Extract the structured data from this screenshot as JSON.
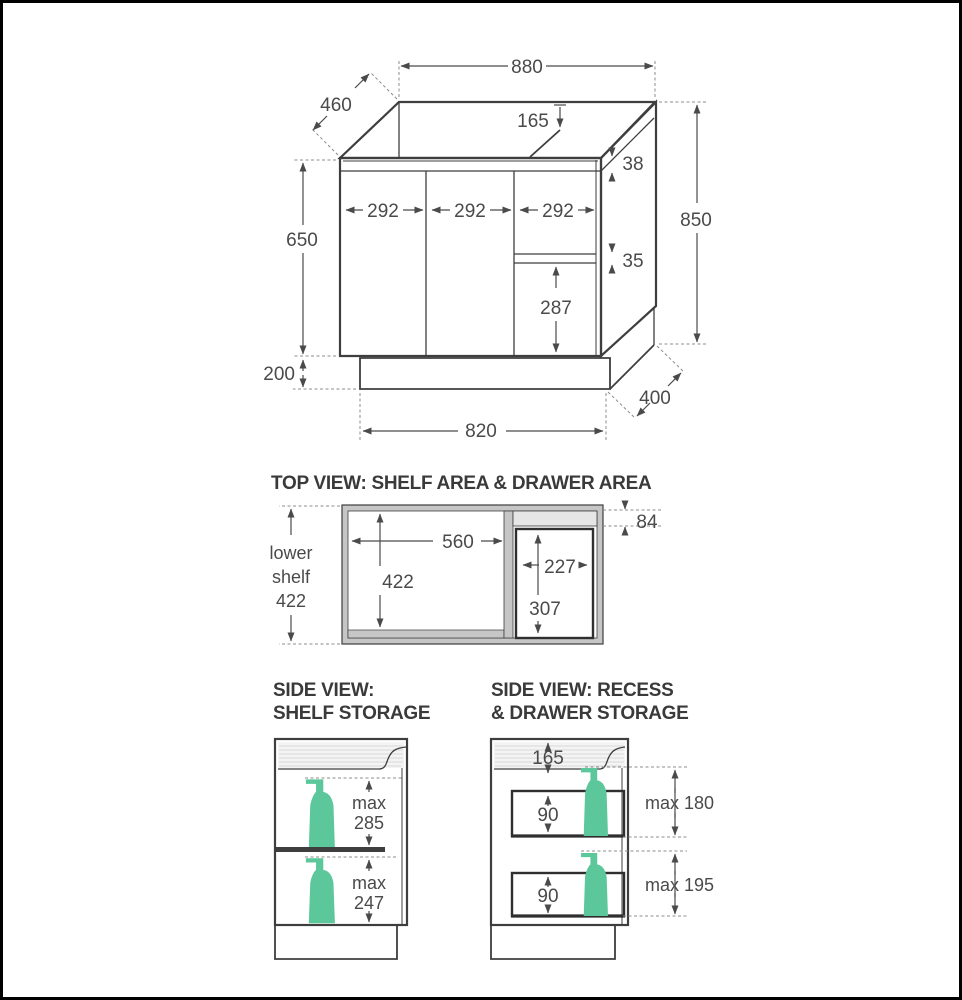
{
  "page": {
    "background": "#ffffff",
    "frame_color": "#000000"
  },
  "colors": {
    "line": "#3e3e3e",
    "dimension": "#4a4a4a",
    "dashed": "#8c8c8c",
    "wall_fill": "#c6c6c6",
    "strip_fill": "#e6e6e6",
    "counter_fill": "#f4f4f4",
    "bottle_green": "#5bc79b"
  },
  "perspective_view": {
    "dims": {
      "top_width": "880",
      "depth": "460",
      "recess_depth": "165",
      "top_rail": "38",
      "door_width_1": "292",
      "door_width_2": "292",
      "door_width_3": "292",
      "body_height": "650",
      "total_height": "850",
      "drawer_gap": "35",
      "drawer_front": "287",
      "kick_height": "200",
      "base_width": "820",
      "base_depth": "400"
    }
  },
  "top_view": {
    "title": "TOP VIEW: SHELF AREA & DRAWER AREA",
    "dims": {
      "shelf_width": "560",
      "shelf_depth": "422",
      "drawer_width": "227",
      "drawer_depth": "307",
      "back_gap": "84"
    },
    "lower_shelf_label": {
      "line1": "lower",
      "line2": "shelf",
      "line3": "422"
    }
  },
  "side_view_shelf": {
    "title_line1": "SIDE VIEW:",
    "title_line2": "SHELF STORAGE",
    "dims": {
      "max_word": "max",
      "upper_max": "285",
      "lower_max": "247"
    }
  },
  "side_view_drawer": {
    "title_line1": "SIDE VIEW: RECESS",
    "title_line2": "& DRAWER STORAGE",
    "dims": {
      "recess_depth": "165",
      "upper_drawer_height": "90",
      "lower_drawer_height": "90",
      "upper_max": "max 180",
      "lower_max": "max 195"
    }
  }
}
